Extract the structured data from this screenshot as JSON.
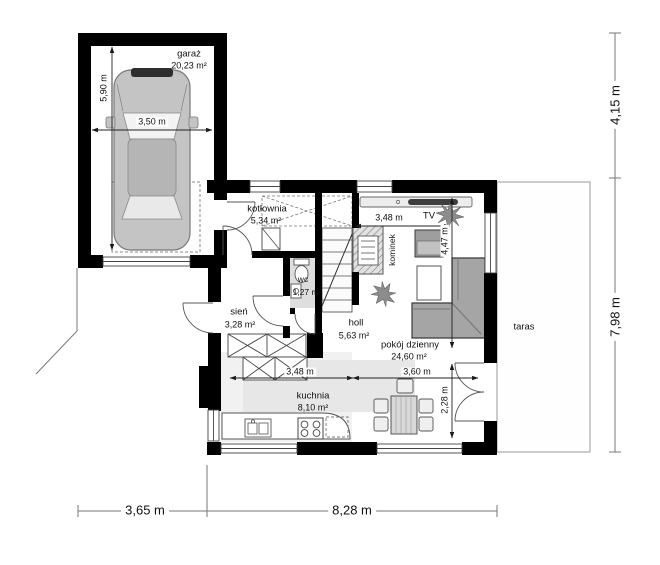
{
  "plan_type": "floor-plan",
  "rooms": {
    "garage": {
      "name": "garaż",
      "area": "20,23 m²"
    },
    "boiler": {
      "name": "kotłownia",
      "area": "5,34 m²"
    },
    "wc": {
      "name": "wc",
      "area": "1,27 m²"
    },
    "vestibule": {
      "name": "sień",
      "area": "3,28 m²"
    },
    "hall": {
      "name": "holl",
      "area": "5,63 m²"
    },
    "living": {
      "name": "pokój dzienny",
      "area": "24,60 m²"
    },
    "kitchen": {
      "name": "kuchnia",
      "area": "8,10 m²"
    },
    "terrace": {
      "name": "taras"
    }
  },
  "labels": {
    "tv": "TV",
    "fireplace": "kominek"
  },
  "dimensions": {
    "garage_depth": "5,90 m",
    "garage_width": "3,50 m",
    "living_width": "3,48 m",
    "living_depth": "4,47 m",
    "kitchen_width": "3,48 m",
    "dining_width": "3,60 m",
    "dining_depth": "2,28 m",
    "overall_left_width": "3,65 m",
    "overall_main_width": "8,28 m",
    "overall_right_top": "4,15 m",
    "overall_right_main": "7,98 m"
  },
  "colors": {
    "wall": "#000000",
    "line": "#555555",
    "floor_tint": "#e7e7e7",
    "furniture_gray": "#9f9f9f"
  }
}
